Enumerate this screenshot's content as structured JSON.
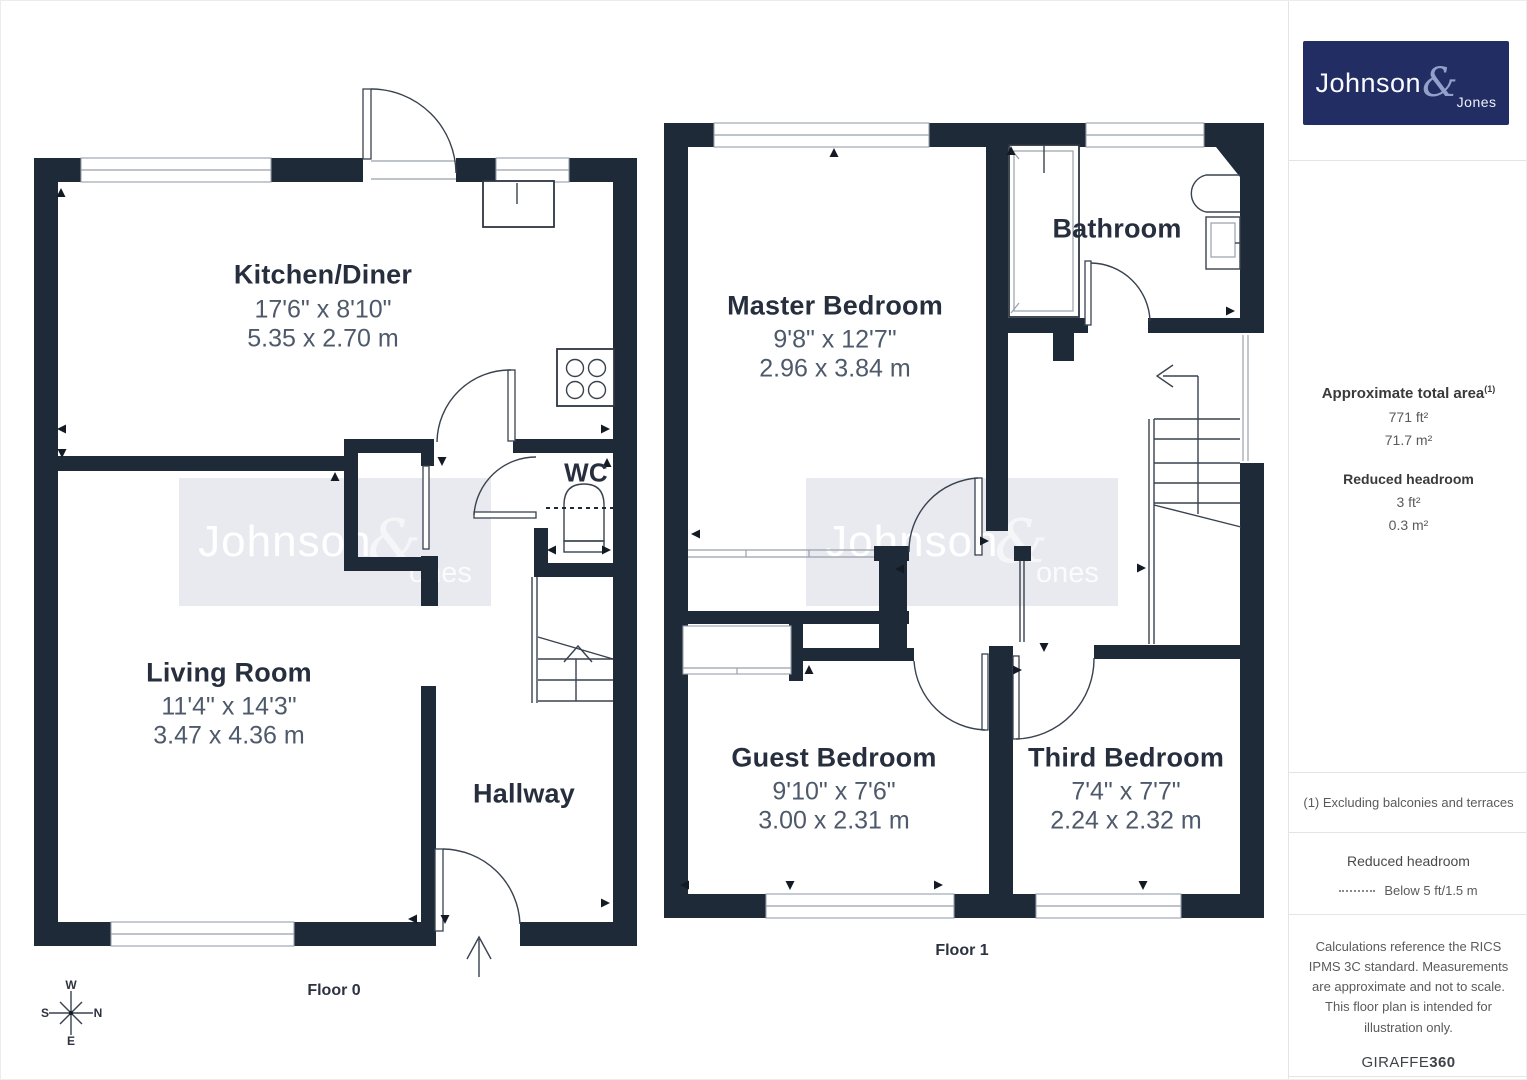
{
  "sidebar": {
    "logo": {
      "primary": "Johnson",
      "amp": "&",
      "secondary": "Jones"
    },
    "area_title": "Approximate total area",
    "area_sup": "(1)",
    "area_ft": "771 ft²",
    "area_m": "71.7 m²",
    "rh_title": "Reduced headroom",
    "rh_ft": "3 ft²",
    "rh_m": "0.3 m²",
    "footnote": "(1) Excluding balconies and terraces",
    "legend_title": "Reduced headroom",
    "legend_label": "Below 5 ft/1.5 m",
    "disclaimer": "Calculations reference the RICS IPMS 3C standard. Measurements are approximate and not to scale. This floor plan is intended for illustration only.",
    "credit_a": "GIRAFFE",
    "credit_b": "360"
  },
  "floor0": {
    "label": "Floor 0",
    "kitchen": {
      "name": "Kitchen/Diner",
      "imperial": "17'6\" x 8'10\"",
      "metric": "5.35 x 2.70 m"
    },
    "living": {
      "name": "Living Room",
      "imperial": "11'4\" x 14'3\"",
      "metric": "3.47 x 4.36 m"
    },
    "wc": {
      "name": "WC"
    },
    "hallway": {
      "name": "Hallway"
    },
    "compass": {
      "n": "N",
      "s": "S",
      "e": "E",
      "w": "W"
    }
  },
  "floor1": {
    "label": "Floor 1",
    "master": {
      "name": "Master Bedroom",
      "imperial": "9'8\" x 12'7\"",
      "metric": "2.96 x 3.84 m"
    },
    "bathroom": {
      "name": "Bathroom"
    },
    "guest": {
      "name": "Guest Bedroom",
      "imperial": "9'10\" x 7'6\"",
      "metric": "3.00 x 2.31 m"
    },
    "third": {
      "name": "Third Bedroom",
      "imperial": "7'4\" x 7'7\"",
      "metric": "2.24 x 2.32 m"
    }
  },
  "watermark": {
    "primary": "Johnson",
    "amp": "&",
    "secondary": "ones"
  }
}
